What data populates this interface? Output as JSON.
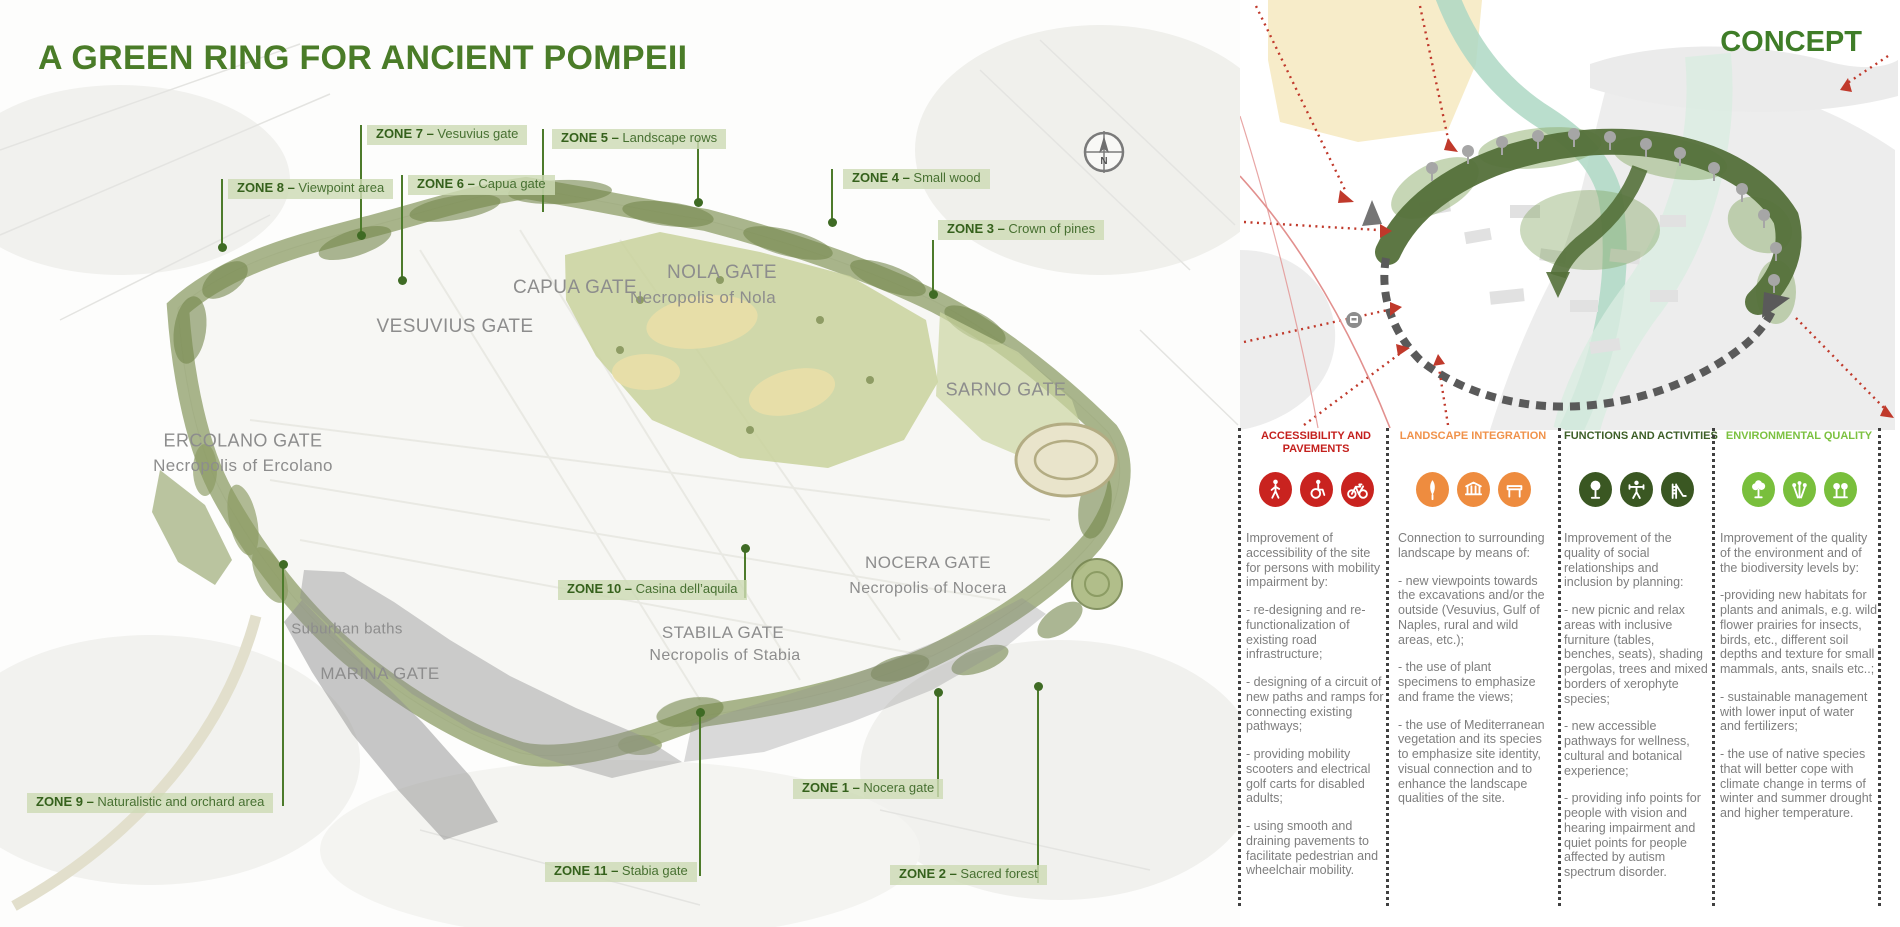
{
  "title": "A GREEN RING FOR ANCIENT POMPEII",
  "map": {
    "compass_label": "N",
    "zones": [
      {
        "id": "1",
        "label": "ZONE 1",
        "desc": "Nocera gate",
        "box": {
          "x": 793,
          "y": 779
        },
        "lines": [
          {
            "x": 938,
            "y1": 692,
            "y2": 797
          }
        ],
        "dots": [
          {
            "x": 938,
            "y": 692
          }
        ]
      },
      {
        "id": "2",
        "label": "ZONE 2",
        "desc": "Sacred forest",
        "box": {
          "x": 890,
          "y": 865
        },
        "lines": [
          {
            "x": 1038,
            "y1": 686,
            "y2": 883
          }
        ],
        "dots": [
          {
            "x": 1038,
            "y": 686
          }
        ]
      },
      {
        "id": "3",
        "label": "ZONE 3",
        "desc": "Crown of pines",
        "box": {
          "x": 938,
          "y": 220
        },
        "lines": [
          {
            "x": 933,
            "y1": 240,
            "y2": 296
          }
        ],
        "dots": [
          {
            "x": 933,
            "y": 294
          }
        ]
      },
      {
        "id": "4",
        "label": "ZONE 4",
        "desc": "Small wood",
        "box": {
          "x": 843,
          "y": 169
        },
        "lines": [
          {
            "x": 832,
            "y1": 169,
            "y2": 224
          }
        ],
        "dots": [
          {
            "x": 832,
            "y": 222
          }
        ]
      },
      {
        "id": "5",
        "label": "ZONE 5",
        "desc": "Landscape rows",
        "box": {
          "x": 552,
          "y": 129
        },
        "lines": [
          {
            "x": 543,
            "y1": 129,
            "y2": 212
          },
          {
            "x": 698,
            "y1": 138,
            "y2": 204
          }
        ],
        "dots": [
          {
            "x": 698,
            "y": 202
          }
        ]
      },
      {
        "id": "6",
        "label": "ZONE 6",
        "desc": "Capua gate",
        "box": {
          "x": 408,
          "y": 175
        },
        "lines": [
          {
            "x": 402,
            "y1": 175,
            "y2": 282
          }
        ],
        "dots": [
          {
            "x": 402,
            "y": 280
          }
        ]
      },
      {
        "id": "7",
        "label": "ZONE 7",
        "desc": "Vesuvius gate",
        "box": {
          "x": 367,
          "y": 125
        },
        "lines": [
          {
            "x": 361,
            "y1": 125,
            "y2": 237
          }
        ],
        "dots": [
          {
            "x": 361,
            "y": 235
          }
        ]
      },
      {
        "id": "8",
        "label": "ZONE 8",
        "desc": "Viewpoint area",
        "box": {
          "x": 228,
          "y": 179
        },
        "lines": [
          {
            "x": 222,
            "y1": 179,
            "y2": 249
          }
        ],
        "dots": [
          {
            "x": 222,
            "y": 247
          }
        ]
      },
      {
        "id": "9",
        "label": "ZONE 9",
        "desc": "Naturalistic and orchard area",
        "box": {
          "x": 27,
          "y": 793
        },
        "lines": [
          {
            "x": 283,
            "y1": 564,
            "y2": 806
          }
        ],
        "dots": [
          {
            "x": 283,
            "y": 564
          }
        ]
      },
      {
        "id": "10",
        "label": "ZONE 10",
        "desc": "Casina dell’aquila",
        "box": {
          "x": 558,
          "y": 580
        },
        "lines": [
          {
            "x": 745,
            "y1": 548,
            "y2": 598
          }
        ],
        "dots": [
          {
            "x": 745,
            "y": 548
          }
        ]
      },
      {
        "id": "11",
        "label": "ZONE 11",
        "desc": "Stabia gate",
        "box": {
          "x": 545,
          "y": 862
        },
        "lines": [
          {
            "x": 700,
            "y1": 712,
            "y2": 876
          }
        ],
        "dots": [
          {
            "x": 700,
            "y": 712
          }
        ]
      }
    ],
    "gates": [
      {
        "name": "VESUVIUS GATE",
        "x": 455,
        "y": 327,
        "size": 19
      },
      {
        "name": "CAPUA GATE",
        "x": 575,
        "y": 288,
        "size": 19
      },
      {
        "name": "NOLA GATE",
        "x": 722,
        "y": 273,
        "size": 19
      },
      {
        "name": "Necropolis of Nola",
        "x": 703,
        "y": 298,
        "size": 17
      },
      {
        "name": "ERCOLANO GATE",
        "x": 243,
        "y": 441,
        "size": 18
      },
      {
        "name": "Necropolis of Ercolano",
        "x": 243,
        "y": 466,
        "size": 17
      },
      {
        "name": "SARNO GATE",
        "x": 1006,
        "y": 390,
        "size": 18
      },
      {
        "name": "NOCERA GATE",
        "x": 928,
        "y": 563,
        "size": 17
      },
      {
        "name": "Necropolis of Nocera",
        "x": 928,
        "y": 589,
        "size": 16
      },
      {
        "name": "STABILA GATE",
        "x": 723,
        "y": 633,
        "size": 17
      },
      {
        "name": "Necropolis of Stabia",
        "x": 725,
        "y": 656,
        "size": 16
      },
      {
        "name": "Suburban baths",
        "x": 347,
        "y": 629,
        "size": 15
      },
      {
        "name": "MARINA GATE",
        "x": 380,
        "y": 674,
        "size": 17
      }
    ]
  },
  "concept": {
    "heading": "CONCEPT",
    "columns": [
      {
        "id": "accessibility",
        "x": 1246,
        "w": 140,
        "title_lines": [
          "ACCESSIBILITY AND",
          "PAVEMENTS"
        ],
        "color": "#c4201d",
        "badge_color": "#c9231f",
        "icons": [
          "pedestrian-icon",
          "wheelchair-icon",
          "bicycle-icon"
        ],
        "paragraphs": [
          "Improvement of accessibility of the site for persons with mobility impairment by:",
          "- re-designing and re-functionalization of existing road infrastructure;",
          "- designing of a circuit of new paths and ramps for connecting existing pathways;",
          "- providing mobility scooters and electrical golf carts for disabled adults;",
          "- using smooth and draining pavements to facilitate pedestrian and wheelchair mobility."
        ]
      },
      {
        "id": "landscape",
        "x": 1398,
        "w": 150,
        "title_lines": [
          "LANDSCAPE INTEGRATION"
        ],
        "color": "#f0924a",
        "badge_color": "#ee8c3f",
        "icons": [
          "cypress-icon",
          "ruins-icon",
          "bench-icon"
        ],
        "paragraphs": [
          "Connection to surrounding landscape by means of:",
          "- new viewpoints towards the excavations and/or the outside (Vesuvius, Gulf of Naples, rural and wild areas, etc.);",
          "-  the use of plant specimens to emphasize and frame the views;",
          "-  the use of Mediterranean vegetation and its species to emphasize site identity, visual connection and to enhance the landscape qualities of the site."
        ]
      },
      {
        "id": "functions",
        "x": 1564,
        "w": 144,
        "title_lines": [
          "FUNCTIONS AND ACTIVITIES"
        ],
        "color": "#3d5f27",
        "badge_color": "#3a5722",
        "icons": [
          "park-tree-icon",
          "fitness-icon",
          "slide-icon"
        ],
        "paragraphs": [
          "Improvement of  the quality of social relationships and inclusion by planning:",
          "- new picnic and relax areas with inclusive furniture  (tables, benches, seats), shading pergolas, trees and mixed borders of xerophyte species;",
          "- new accessible pathways for wellness, cultural and botanical experience;",
          "- providing info points for people with vision and hearing impairment and quiet points for people affected by autism spectrum disorder."
        ]
      },
      {
        "id": "environment",
        "x": 1720,
        "w": 158,
        "title_lines": [
          "ENVIRONMENTAL QUALITY"
        ],
        "color": "#7cc140",
        "badge_color": "#79bf3c",
        "icons": [
          "tree-icon",
          "flowers-icon",
          "grove-icon"
        ],
        "paragraphs": [
          "Improvement of the quality of the environment and of the biodiversity levels by:",
          "-providing new habitats for plants and animals, e.g. wild flower prairies for insects, birds, etc., different soil depths and texture for small mammals, ants, snails etc..;",
          "- sustainable management with lower input of water and fertilizers;",
          "- the use of native species  that will better cope with climate change in terms of winter and summer drought and higher temperature."
        ]
      }
    ]
  }
}
